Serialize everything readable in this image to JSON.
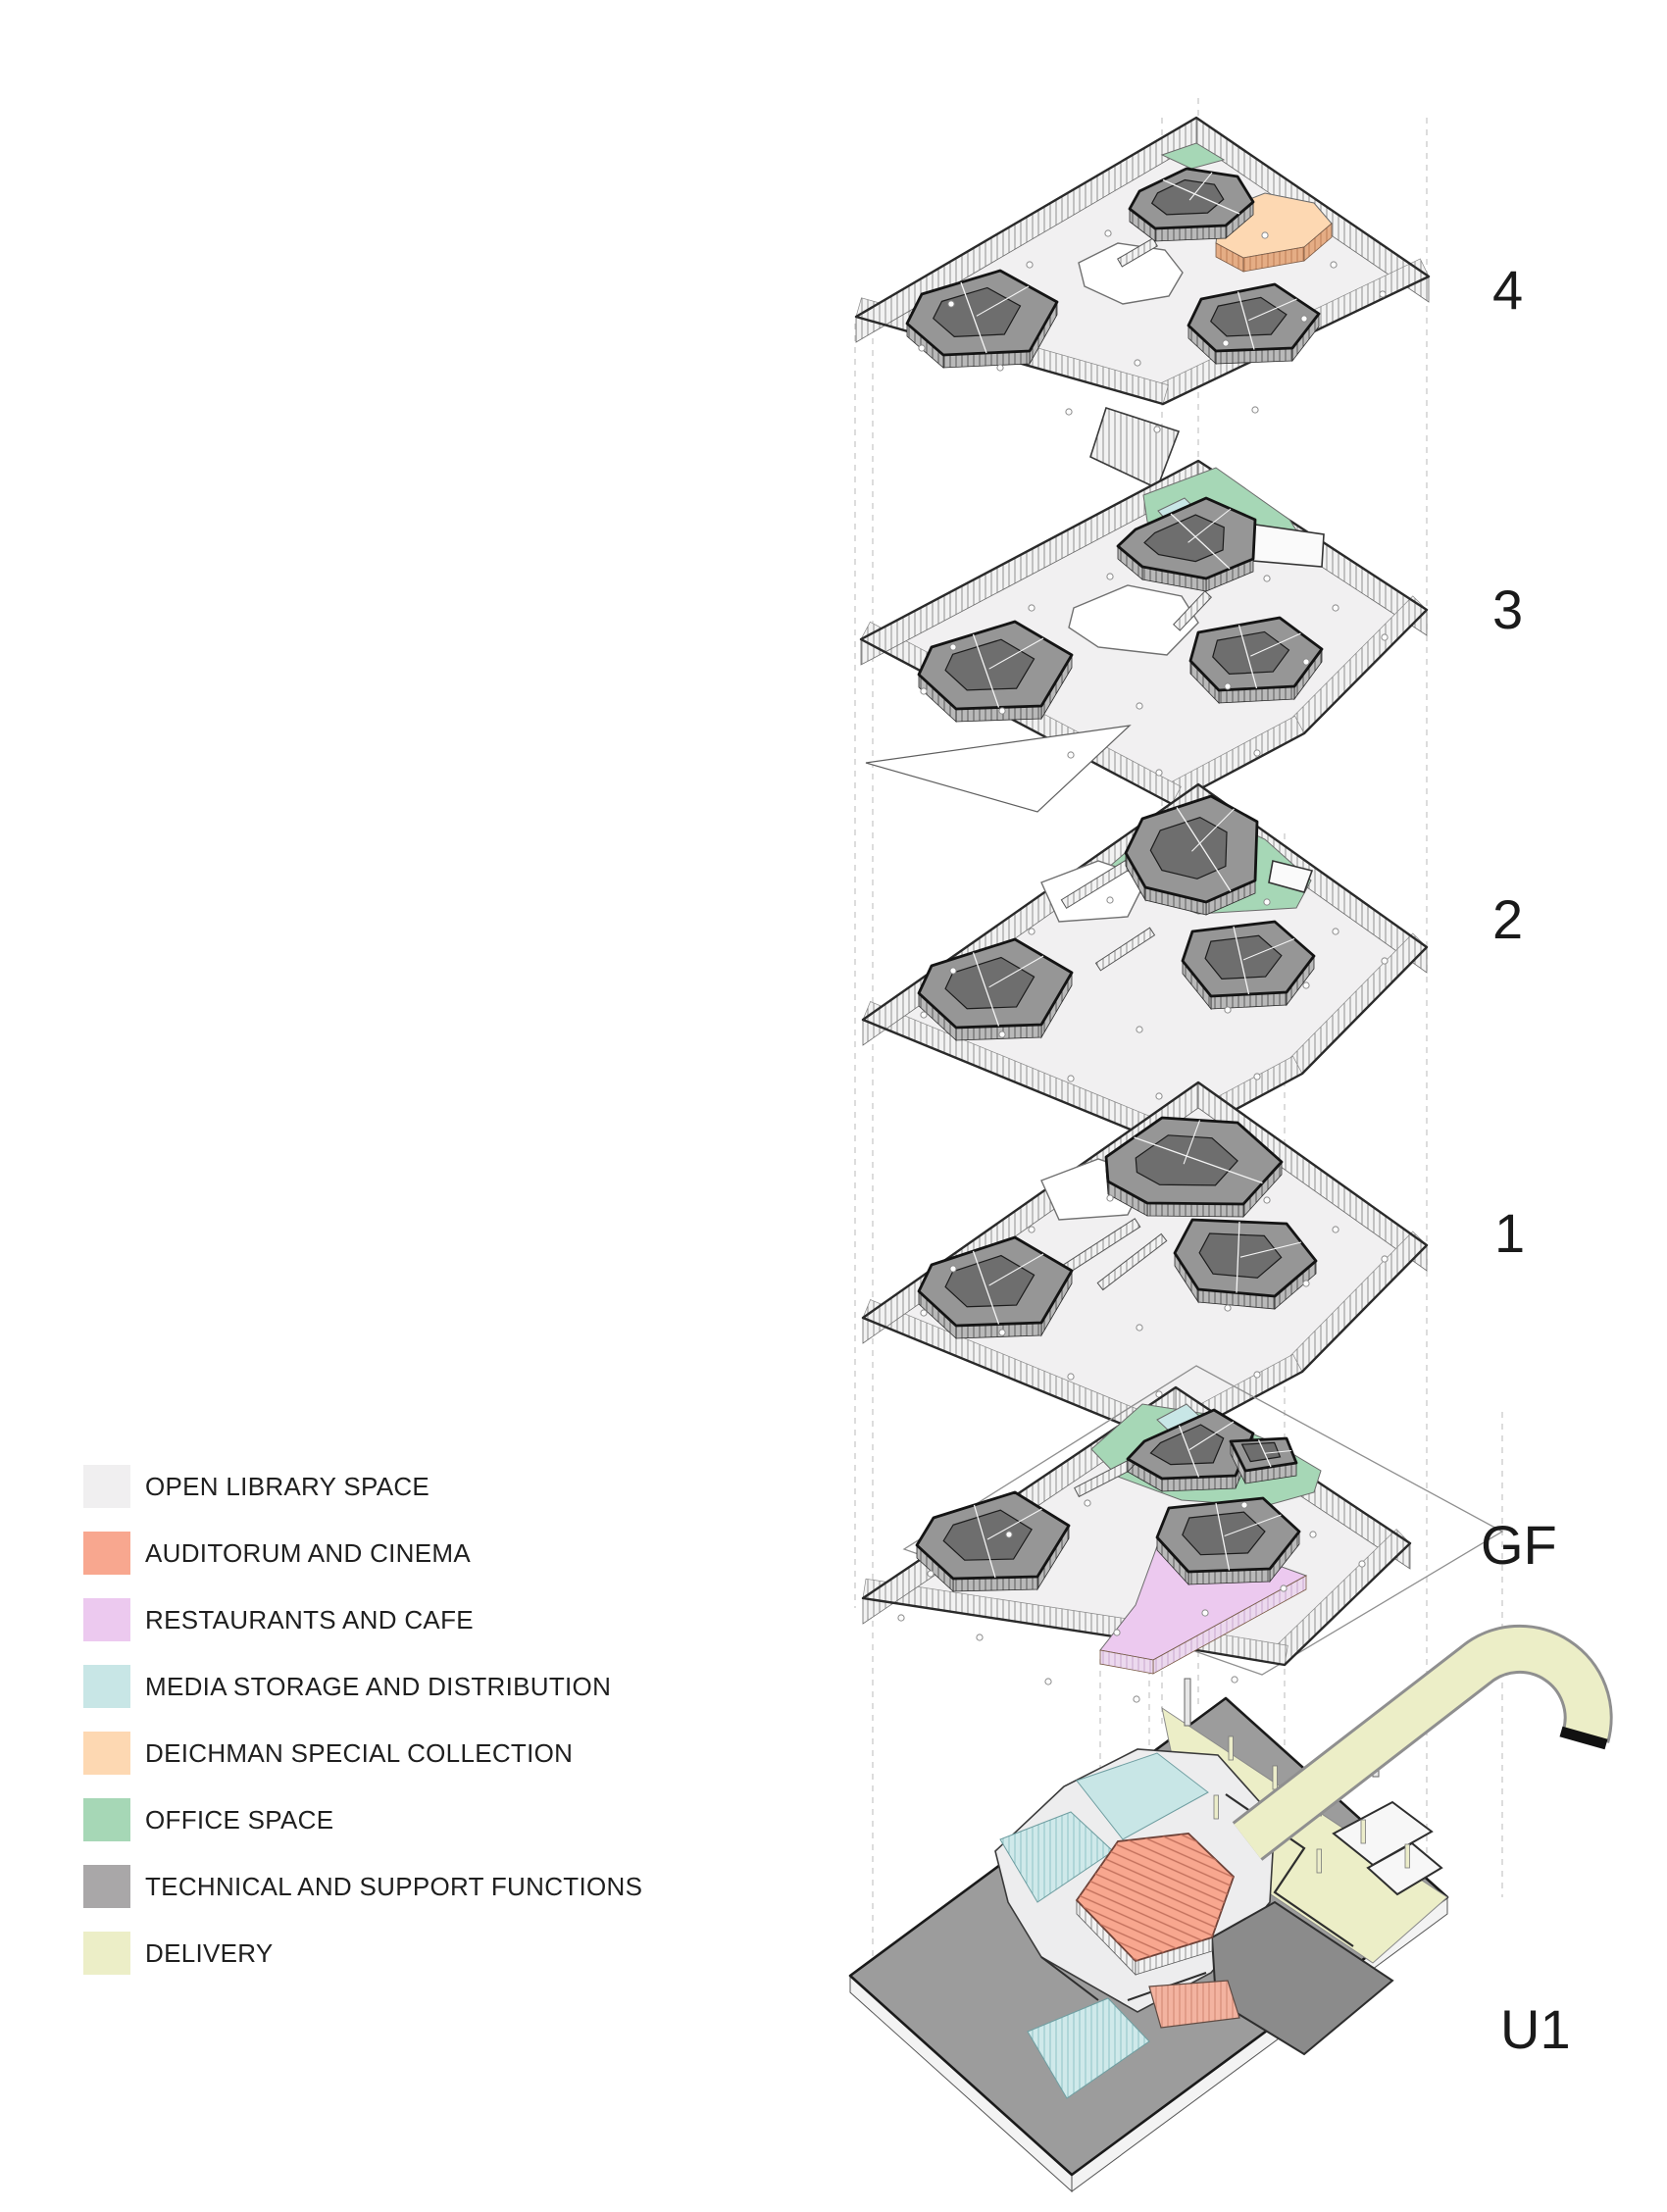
{
  "diagram_title": "",
  "legend": {
    "items": [
      {
        "id": "open",
        "label": "OPEN LIBRARY SPACE",
        "color": "#f0eff0"
      },
      {
        "id": "auditorium",
        "label": "AUDITORUM AND CINEMA",
        "color": "#f8a78f"
      },
      {
        "id": "restaurants",
        "label": "RESTAURANTS AND CAFE",
        "color": "#ecc9ef"
      },
      {
        "id": "media",
        "label": "MEDIA STORAGE AND DISTRIBUTION",
        "color": "#c8e6e6"
      },
      {
        "id": "deichman",
        "label": "DEICHMAN SPECIAL COLLECTION",
        "color": "#fdd8b2"
      },
      {
        "id": "office",
        "label": "OFFICE SPACE",
        "color": "#a6d7b6"
      },
      {
        "id": "technical",
        "label": "TECHNICAL AND SUPPORT FUNCTIONS",
        "color": "#a9a7a8"
      },
      {
        "id": "delivery",
        "label": "DELIVERY",
        "color": "#eceec7"
      }
    ]
  },
  "floors": [
    {
      "id": "4",
      "label": "4",
      "zones": [
        "open",
        "office",
        "deichman",
        "technical"
      ]
    },
    {
      "id": "3",
      "label": "3",
      "zones": [
        "open",
        "office",
        "media",
        "technical"
      ]
    },
    {
      "id": "2",
      "label": "2",
      "zones": [
        "open",
        "office",
        "technical"
      ]
    },
    {
      "id": "1",
      "label": "1",
      "zones": [
        "open",
        "media",
        "technical"
      ]
    },
    {
      "id": "GF",
      "label": "GF",
      "zones": [
        "open",
        "office",
        "media",
        "restaurants",
        "technical"
      ]
    },
    {
      "id": "U1",
      "label": "U1",
      "zones": [
        "technical",
        "media",
        "delivery",
        "auditorium",
        "open"
      ]
    }
  ],
  "colors": {
    "plate_surface": "#f1f0f1",
    "plate_outline": "#2a2a2a",
    "core_fill": "#969696",
    "core_dark": "#6e6e6e",
    "core_outline": "#141414",
    "u1_surface": "#9c9c9c",
    "u1_dark_rooms": "#8b8b8b",
    "ramp_tip": "#111111",
    "dashed_line": "#c6c6c6",
    "label_text": "#1a1a1a"
  }
}
